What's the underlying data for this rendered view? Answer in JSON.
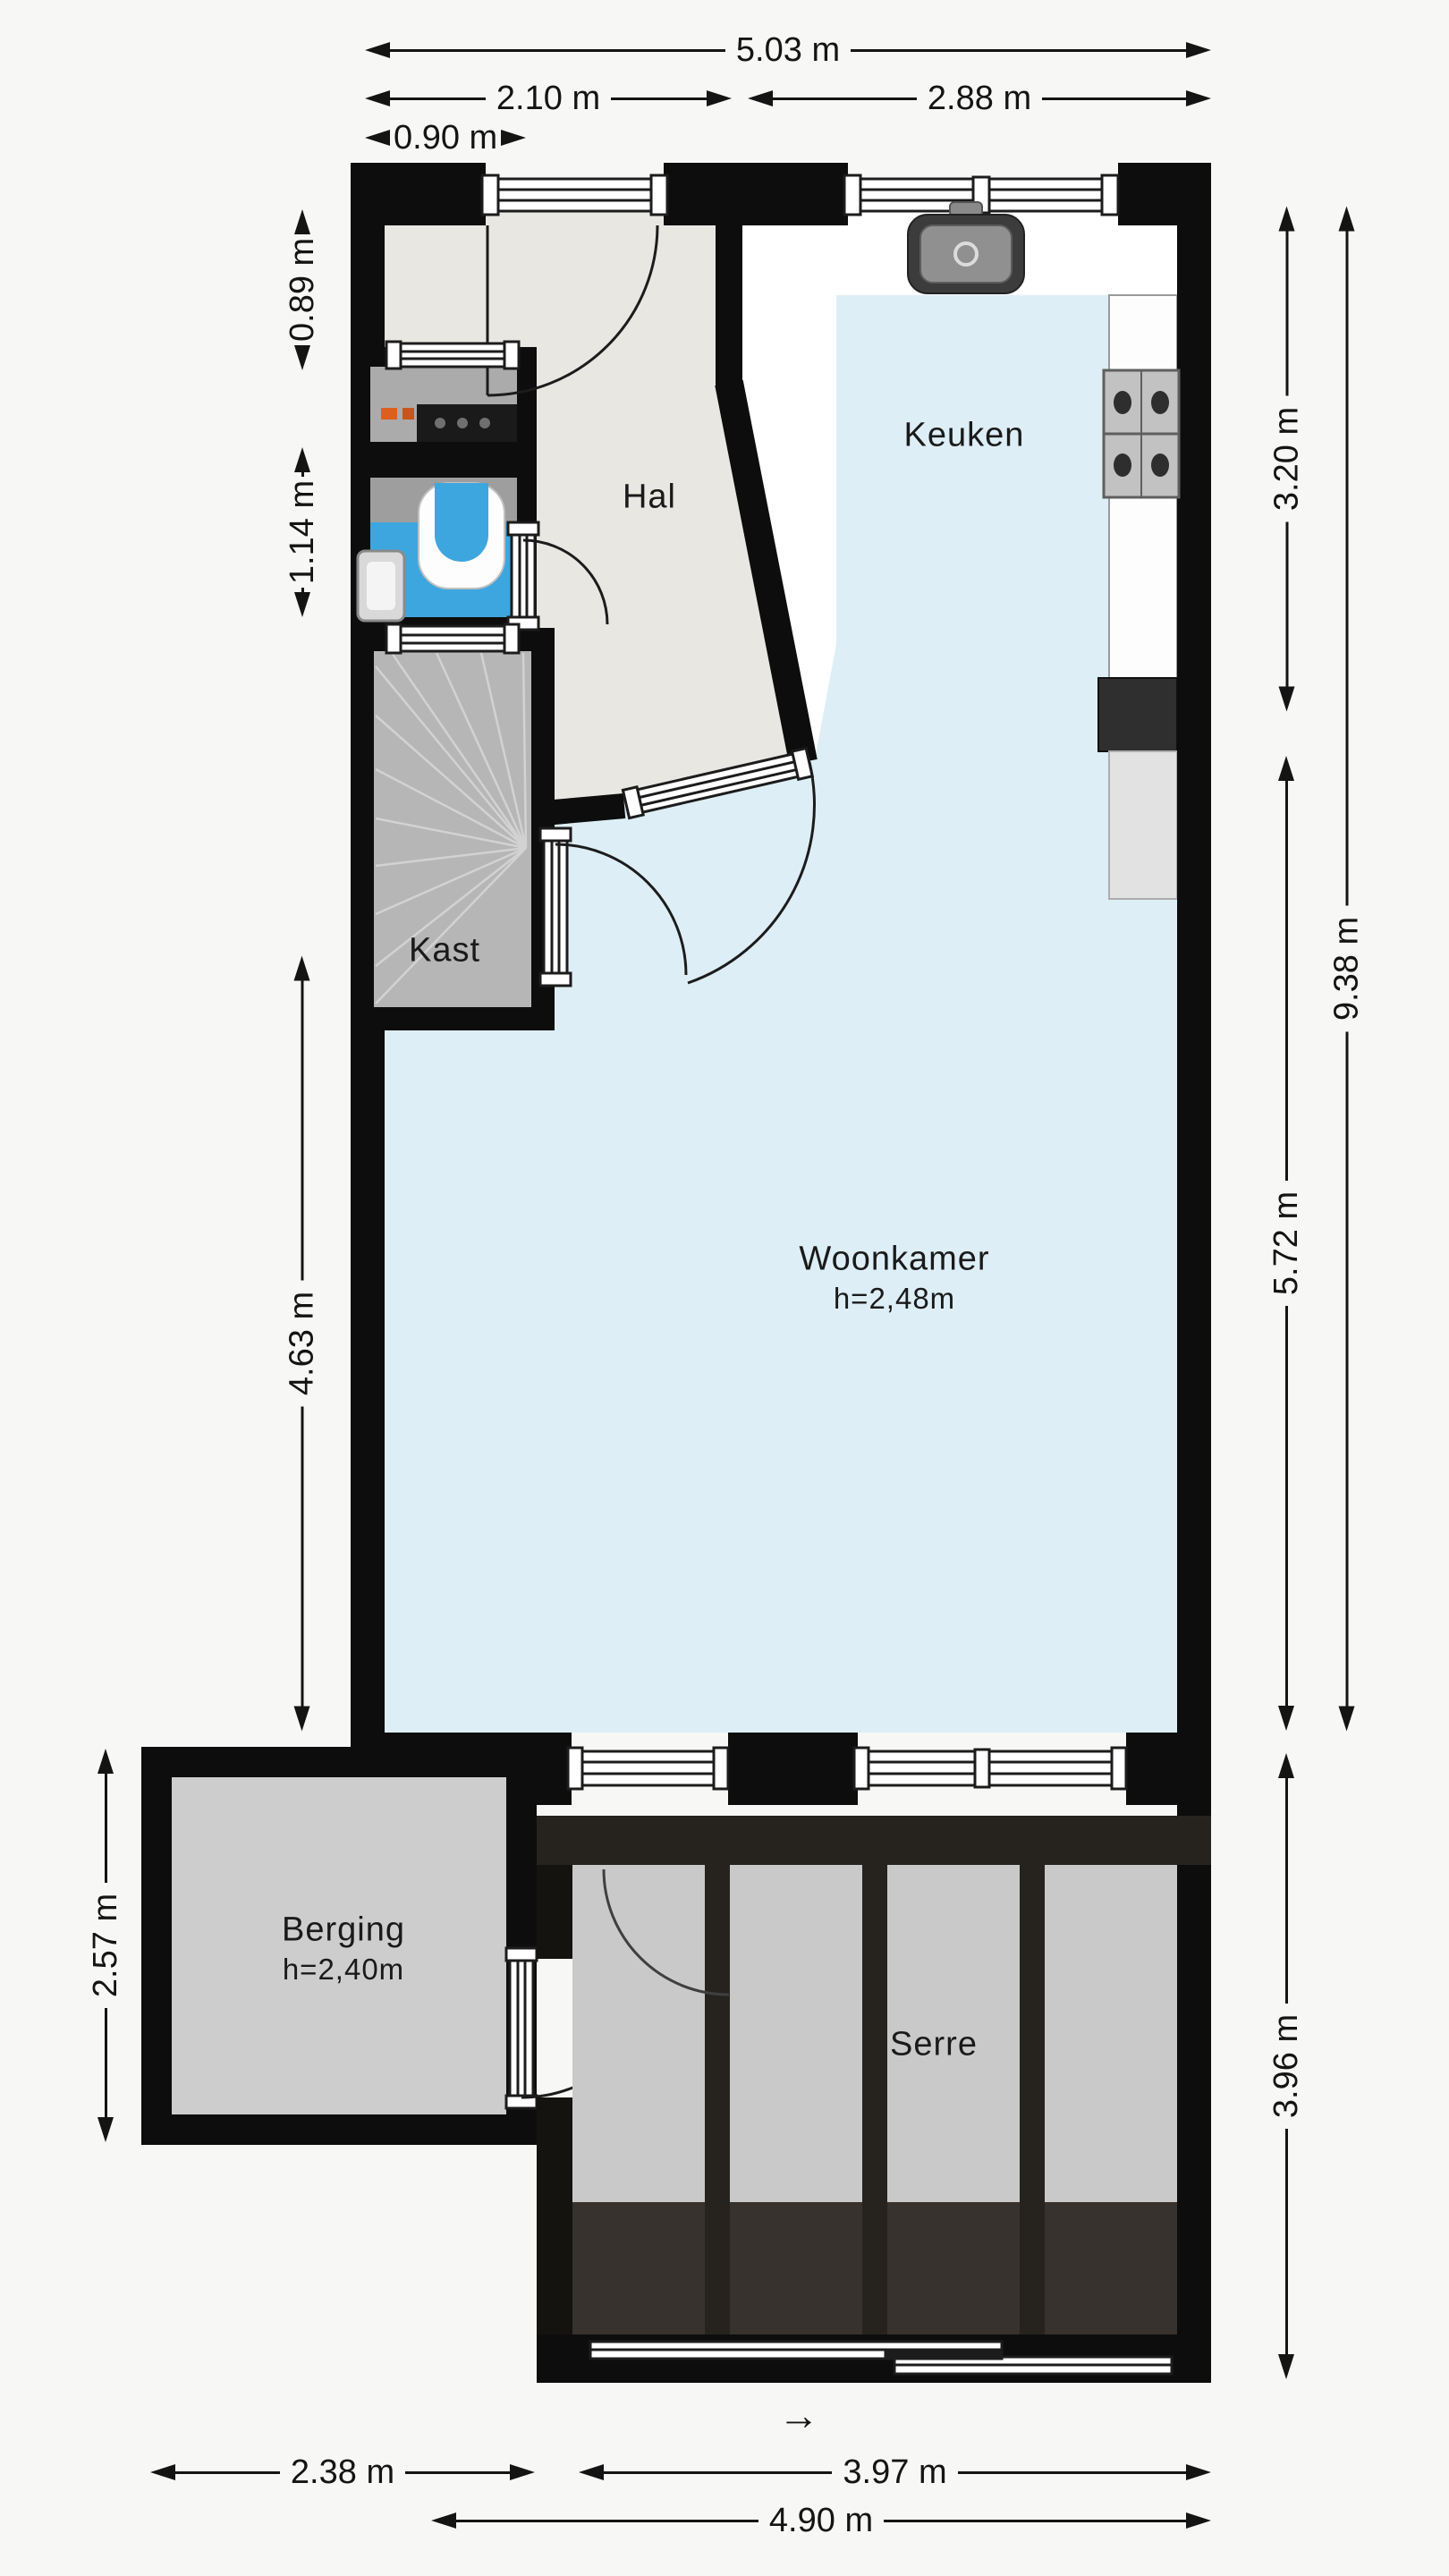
{
  "floorplan": {
    "rooms": {
      "hal": {
        "label": "Hal"
      },
      "keuken": {
        "label": "Keuken"
      },
      "kast": {
        "label": "Kast"
      },
      "woonkamer": {
        "label": "Woonkamer",
        "height": "h=2,48m"
      },
      "berging": {
        "label": "Berging",
        "height": "h=2,40m"
      },
      "serre": {
        "label": "Serre"
      }
    },
    "dimensions": {
      "top": {
        "total": "5.03 m",
        "hal_width": "2.10 m",
        "keuken_width": "2.88 m",
        "entry": "0.90 m"
      },
      "left": {
        "meterkast": "0.89 m",
        "toilet": "1.14 m",
        "woonkamer": "4.63 m",
        "berging": "2.57 m"
      },
      "right": {
        "keuken": "3.20 m",
        "woonkamer": "5.72 m",
        "total": "9.38 m",
        "serre": "3.96 m"
      },
      "bottom": {
        "berging": "2.38 m",
        "serre": "3.97 m",
        "total": "4.90 m"
      }
    },
    "annotations": {
      "slide_direction": "→"
    },
    "colors": {
      "wall": "#0d0d0d",
      "hal_floor": "#e8e7e2",
      "living_floor": "#ddeef6",
      "toilet_floor": "#3ea6de",
      "kast_floor": "#b6b6b6",
      "berging_floor": "#cdcdcd",
      "serre_panel": "#c9c9c9",
      "serre_frame": "#26231f"
    }
  }
}
